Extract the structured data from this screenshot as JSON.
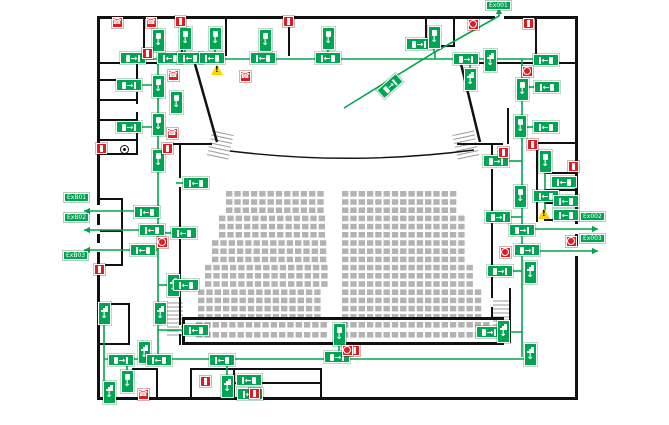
{
  "plan": {
    "title": "auditorium-evacuation-plan",
    "width": 669,
    "height": 425,
    "colors": {
      "route_green": "#00a551",
      "alarm_red": "#e01b22",
      "warn_yellow": "#ffd500",
      "wall": "#111111",
      "seat_gray": "#b3b3b3",
      "stair_gray": "#999999",
      "floor": "#ffffff"
    },
    "walls": [
      [
        97,
        16,
        481,
        3
      ],
      [
        97,
        397,
        481,
        3
      ],
      [
        97,
        16,
        3,
        384
      ],
      [
        575,
        16,
        3,
        384
      ],
      [
        143,
        16,
        2,
        46
      ],
      [
        181,
        16,
        2,
        46
      ],
      [
        225,
        16,
        2,
        40
      ],
      [
        288,
        16,
        2,
        40
      ],
      [
        425,
        16,
        2,
        31
      ],
      [
        453,
        16,
        2,
        31
      ],
      [
        425,
        45,
        30,
        2
      ],
      [
        535,
        16,
        2,
        50
      ],
      [
        97,
        62,
        98,
        2
      ],
      [
        460,
        62,
        118,
        2
      ],
      [
        136,
        62,
        2,
        93
      ],
      [
        97,
        79,
        40,
        2
      ],
      [
        97,
        99,
        40,
        2
      ],
      [
        97,
        119,
        40,
        2
      ],
      [
        97,
        139,
        40,
        2
      ],
      [
        97,
        153,
        41,
        2
      ],
      [
        99,
        198,
        24,
        2
      ],
      [
        121,
        198,
        2,
        68
      ],
      [
        99,
        230,
        24,
        2
      ],
      [
        99,
        264,
        24,
        2
      ],
      [
        99,
        303,
        31,
        2
      ],
      [
        128,
        303,
        2,
        42
      ],
      [
        99,
        343,
        31,
        2
      ],
      [
        166,
        143,
        46,
        2
      ],
      [
        179,
        145,
        2,
        200
      ],
      [
        457,
        143,
        46,
        2
      ],
      [
        491,
        145,
        2,
        173
      ],
      [
        182,
        317,
        322,
        3
      ],
      [
        182,
        342,
        322,
        3
      ],
      [
        182,
        317,
        3,
        27
      ],
      [
        501,
        317,
        3,
        27
      ],
      [
        132,
        368,
        26,
        2
      ],
      [
        156,
        368,
        2,
        31
      ],
      [
        190,
        368,
        132,
        2
      ],
      [
        190,
        368,
        2,
        31
      ],
      [
        233,
        368,
        2,
        31
      ],
      [
        320,
        368,
        2,
        31
      ],
      [
        233,
        382,
        89,
        2
      ],
      [
        507,
        108,
        2,
        36
      ],
      [
        536,
        142,
        42,
        2
      ],
      [
        536,
        142,
        2,
        80
      ],
      [
        544,
        172,
        34,
        2
      ],
      [
        544,
        189,
        34,
        2
      ],
      [
        544,
        202,
        34,
        2
      ],
      [
        544,
        219,
        34,
        2
      ],
      [
        509,
        288,
        2,
        55
      ]
    ],
    "diagonal_walls": [
      [
        195,
        64,
        217,
        142
      ],
      [
        461,
        64,
        480,
        142
      ]
    ],
    "door_gaps": [
      [
        97,
        205,
        3,
        9
      ],
      [
        97,
        225,
        3,
        9
      ],
      [
        97,
        243,
        3,
        9
      ],
      [
        575,
        224,
        3,
        10
      ],
      [
        575,
        246,
        3,
        10
      ],
      [
        495,
        16,
        9,
        3
      ],
      [
        136,
        84,
        2,
        8
      ],
      [
        136,
        104,
        2,
        8
      ],
      [
        179,
        178,
        2,
        9
      ],
      [
        179,
        325,
        2,
        9
      ],
      [
        491,
        160,
        2,
        9
      ],
      [
        491,
        298,
        2,
        9
      ]
    ],
    "stage_front_curve": "M230,151 Q352,166 474,150",
    "stairs": [
      {
        "x": 209,
        "y": 133,
        "w": 22,
        "h": 26,
        "rot": 12
      },
      {
        "x": 455,
        "y": 133,
        "w": 22,
        "h": 26,
        "rot": -12
      },
      {
        "x": 167,
        "y": 303,
        "w": 16,
        "h": 33,
        "rot": 0
      },
      {
        "x": 493,
        "y": 301,
        "w": 17,
        "h": 24,
        "rot": 0
      }
    ],
    "routes": [
      {
        "pts": [
          [
            120,
            59
          ],
          [
            556,
            59
          ]
        ]
      },
      {
        "pts": [
          [
            158,
            59
          ],
          [
            158,
            360
          ]
        ]
      },
      {
        "pts": [
          [
            522,
            59
          ],
          [
            522,
            357
          ]
        ]
      },
      {
        "pts": [
          [
            104,
            359
          ],
          [
            530,
            359
          ]
        ]
      },
      {
        "pts": [
          [
            344,
            108
          ],
          [
            435,
            52
          ],
          [
            499,
            16
          ],
          [
            499,
            8
          ]
        ],
        "arrow": true
      },
      {
        "pts": [
          [
            435,
            52
          ],
          [
            435,
            59
          ]
        ]
      },
      {
        "pts": [
          [
            158,
            211
          ],
          [
            84,
            211
          ]
        ],
        "arrow": true
      },
      {
        "pts": [
          [
            158,
            230
          ],
          [
            84,
            230
          ]
        ],
        "arrow": true
      },
      {
        "pts": [
          [
            158,
            250
          ],
          [
            84,
            250
          ]
        ],
        "arrow": true
      },
      {
        "pts": [
          [
            522,
            229
          ],
          [
            598,
            229
          ]
        ],
        "arrow": true
      },
      {
        "pts": [
          [
            522,
            251
          ],
          [
            598,
            251
          ]
        ],
        "arrow": true
      },
      {
        "pts": [
          [
            176,
            183
          ],
          [
            190,
            183
          ]
        ]
      },
      {
        "pts": [
          [
            158,
            233
          ],
          [
            171,
            233
          ]
        ]
      },
      {
        "pts": [
          [
            135,
            85
          ],
          [
            152,
            85
          ]
        ]
      },
      {
        "pts": [
          [
            135,
            127
          ],
          [
            152,
            127
          ]
        ]
      },
      {
        "pts": [
          [
            158,
            44
          ],
          [
            158,
            59
          ]
        ]
      },
      {
        "pts": [
          [
            185,
            46
          ],
          [
            185,
            59
          ]
        ]
      },
      {
        "pts": [
          [
            215,
            46
          ],
          [
            215,
            59
          ]
        ]
      },
      {
        "pts": [
          [
            265,
            48
          ],
          [
            265,
            59
          ]
        ]
      },
      {
        "pts": [
          [
            328,
            46
          ],
          [
            328,
            59
          ]
        ]
      },
      {
        "pts": [
          [
            434,
            45
          ],
          [
            434,
            52
          ]
        ]
      },
      {
        "pts": [
          [
            470,
            59
          ],
          [
            470,
            70
          ]
        ]
      },
      {
        "pts": [
          [
            522,
            87
          ],
          [
            535,
            87
          ]
        ]
      },
      {
        "pts": [
          [
            522,
            127
          ],
          [
            534,
            127
          ]
        ]
      },
      {
        "pts": [
          [
            509,
            161
          ],
          [
            522,
            161
          ]
        ]
      },
      {
        "pts": [
          [
            545,
            170
          ],
          [
            545,
            211
          ]
        ]
      },
      {
        "pts": [
          [
            510,
            217
          ],
          [
            522,
            217
          ]
        ]
      },
      {
        "pts": [
          [
            513,
            271
          ],
          [
            522,
            271
          ]
        ]
      },
      {
        "pts": [
          [
            158,
            285
          ],
          [
            173,
            285
          ]
        ]
      },
      {
        "pts": [
          [
            104,
            325
          ],
          [
            104,
            390
          ]
        ]
      },
      {
        "pts": [
          [
            127,
            360
          ],
          [
            127,
            372
          ]
        ]
      },
      {
        "pts": [
          [
            144,
            341
          ],
          [
            144,
            359
          ]
        ]
      },
      {
        "pts": [
          [
            227,
            360
          ],
          [
            227,
            394
          ]
        ]
      },
      {
        "pts": [
          [
            339,
            345
          ],
          [
            339,
            359
          ]
        ]
      },
      {
        "pts": [
          [
            158,
            330
          ],
          [
            183,
            330
          ]
        ]
      },
      {
        "pts": [
          [
            502,
            332
          ],
          [
            522,
            332
          ]
        ]
      }
    ],
    "signs": [
      {
        "x": 133,
        "y": 58,
        "t": "hr"
      },
      {
        "x": 170,
        "y": 58,
        "t": "hl"
      },
      {
        "x": 190,
        "y": 58,
        "t": "hl"
      },
      {
        "x": 212,
        "y": 58,
        "t": "hl"
      },
      {
        "x": 263,
        "y": 58,
        "t": "hl"
      },
      {
        "x": 328,
        "y": 58,
        "t": "hl"
      },
      {
        "x": 419,
        "y": 44,
        "t": "hr"
      },
      {
        "x": 466,
        "y": 59,
        "t": "hr"
      },
      {
        "x": 546,
        "y": 60,
        "t": "hl"
      },
      {
        "x": 158,
        "y": 40,
        "t": "vd"
      },
      {
        "x": 185,
        "y": 38,
        "t": "vd"
      },
      {
        "x": 215,
        "y": 38,
        "t": "vd"
      },
      {
        "x": 265,
        "y": 40,
        "t": "vd"
      },
      {
        "x": 328,
        "y": 38,
        "t": "vd"
      },
      {
        "x": 434,
        "y": 37,
        "t": "vd"
      },
      {
        "x": 490,
        "y": 60,
        "t": "vs"
      },
      {
        "x": 470,
        "y": 79,
        "t": "vs"
      },
      {
        "x": 522,
        "y": 89,
        "t": "vd"
      },
      {
        "x": 547,
        "y": 87,
        "t": "hl"
      },
      {
        "x": 390,
        "y": 86,
        "t": "hr",
        "rot": -42
      },
      {
        "x": 129,
        "y": 85,
        "t": "hr"
      },
      {
        "x": 158,
        "y": 86,
        "t": "vd"
      },
      {
        "x": 176,
        "y": 102,
        "t": "vd"
      },
      {
        "x": 129,
        "y": 127,
        "t": "hr"
      },
      {
        "x": 158,
        "y": 124,
        "t": "vd"
      },
      {
        "x": 158,
        "y": 160,
        "t": "vd"
      },
      {
        "x": 196,
        "y": 183,
        "t": "hl"
      },
      {
        "x": 147,
        "y": 212,
        "t": "hl"
      },
      {
        "x": 152,
        "y": 230,
        "t": "hl"
      },
      {
        "x": 184,
        "y": 233,
        "t": "hl"
      },
      {
        "x": 143,
        "y": 250,
        "t": "hl"
      },
      {
        "x": 173,
        "y": 285,
        "t": "vs"
      },
      {
        "x": 186,
        "y": 285,
        "t": "hl"
      },
      {
        "x": 520,
        "y": 126,
        "t": "vd"
      },
      {
        "x": 546,
        "y": 127,
        "t": "hl"
      },
      {
        "x": 496,
        "y": 161,
        "t": "hr"
      },
      {
        "x": 545,
        "y": 161,
        "t": "vd"
      },
      {
        "x": 520,
        "y": 196,
        "t": "vd"
      },
      {
        "x": 564,
        "y": 182,
        "t": "hl"
      },
      {
        "x": 546,
        "y": 196,
        "t": "hl"
      },
      {
        "x": 566,
        "y": 201,
        "t": "hl"
      },
      {
        "x": 566,
        "y": 215,
        "t": "hl"
      },
      {
        "x": 498,
        "y": 217,
        "t": "hr"
      },
      {
        "x": 522,
        "y": 230,
        "t": "hr"
      },
      {
        "x": 527,
        "y": 250,
        "t": "hr"
      },
      {
        "x": 500,
        "y": 271,
        "t": "hr"
      },
      {
        "x": 530,
        "y": 272,
        "t": "vs"
      },
      {
        "x": 104,
        "y": 313,
        "t": "vs"
      },
      {
        "x": 160,
        "y": 313,
        "t": "vs"
      },
      {
        "x": 144,
        "y": 352,
        "t": "vs"
      },
      {
        "x": 121,
        "y": 360,
        "t": "hr"
      },
      {
        "x": 159,
        "y": 360,
        "t": "hl"
      },
      {
        "x": 222,
        "y": 360,
        "t": "hl"
      },
      {
        "x": 127,
        "y": 381,
        "t": "vd"
      },
      {
        "x": 109,
        "y": 392,
        "t": "vs"
      },
      {
        "x": 227,
        "y": 386,
        "t": "vs"
      },
      {
        "x": 249,
        "y": 380,
        "t": "hl"
      },
      {
        "x": 250,
        "y": 394,
        "t": "hl"
      },
      {
        "x": 196,
        "y": 330,
        "t": "hl"
      },
      {
        "x": 339,
        "y": 334,
        "t": "vd"
      },
      {
        "x": 337,
        "y": 357,
        "t": "hr"
      },
      {
        "x": 489,
        "y": 332,
        "t": "hr"
      },
      {
        "x": 503,
        "y": 331,
        "t": "vs"
      },
      {
        "x": 530,
        "y": 354,
        "t": "vs"
      }
    ],
    "safety_icons": [
      {
        "x": 117,
        "y": 22,
        "t": "phone"
      },
      {
        "x": 151,
        "y": 22,
        "t": "phone"
      },
      {
        "x": 173,
        "y": 75,
        "t": "phone"
      },
      {
        "x": 245,
        "y": 76,
        "t": "phone"
      },
      {
        "x": 172,
        "y": 133,
        "t": "phone"
      },
      {
        "x": 143,
        "y": 394,
        "t": "phone"
      },
      {
        "x": 180,
        "y": 21,
        "t": "cp"
      },
      {
        "x": 288,
        "y": 21,
        "t": "cp"
      },
      {
        "x": 528,
        "y": 23,
        "t": "cp"
      },
      {
        "x": 147,
        "y": 53,
        "t": "cp"
      },
      {
        "x": 101,
        "y": 148,
        "t": "cp"
      },
      {
        "x": 167,
        "y": 148,
        "t": "cp"
      },
      {
        "x": 532,
        "y": 144,
        "t": "cp"
      },
      {
        "x": 503,
        "y": 152,
        "t": "cp"
      },
      {
        "x": 573,
        "y": 166,
        "t": "cp"
      },
      {
        "x": 99,
        "y": 269,
        "t": "cp"
      },
      {
        "x": 205,
        "y": 381,
        "t": "cp"
      },
      {
        "x": 254,
        "y": 393,
        "t": "cp"
      },
      {
        "x": 354,
        "y": 350,
        "t": "cp"
      },
      {
        "x": 473,
        "y": 24,
        "t": "ext"
      },
      {
        "x": 527,
        "y": 71,
        "t": "ext"
      },
      {
        "x": 162,
        "y": 242,
        "t": "ext"
      },
      {
        "x": 571,
        "y": 241,
        "t": "ext"
      },
      {
        "x": 505,
        "y": 252,
        "t": "ext"
      },
      {
        "x": 347,
        "y": 350,
        "t": "ext"
      },
      {
        "x": 217,
        "y": 70,
        "t": "warn"
      },
      {
        "x": 544,
        "y": 214,
        "t": "warn"
      },
      {
        "x": 125,
        "y": 150,
        "t": "hyd"
      }
    ],
    "route_labels": [
      {
        "x": 64,
        "y": 193,
        "text": "ExB01"
      },
      {
        "x": 64,
        "y": 213,
        "text": "ExB02"
      },
      {
        "x": 63,
        "y": 251,
        "text": "ExB03"
      },
      {
        "x": 486,
        "y": 1,
        "text": "Ex001"
      },
      {
        "x": 580,
        "y": 212,
        "text": "Ex002"
      },
      {
        "x": 580,
        "y": 234,
        "text": "Ex003"
      }
    ],
    "seating": {
      "main": {
        "rows": 16,
        "y0": 191,
        "pitch_y": 8.2,
        "left_end": 330,
        "right_start": 342,
        "left_base": 226,
        "right_base": 460,
        "step_every": 3,
        "step_px": 7,
        "max_step": 4
      },
      "rear": {
        "ys": [
          322,
          332
        ],
        "left_start": 196,
        "aisle": [
          330,
          342
        ],
        "right_end": 494
      },
      "seat": {
        "w": 6.4,
        "h": 5.6,
        "pitch_x": 8.3
      }
    }
  }
}
